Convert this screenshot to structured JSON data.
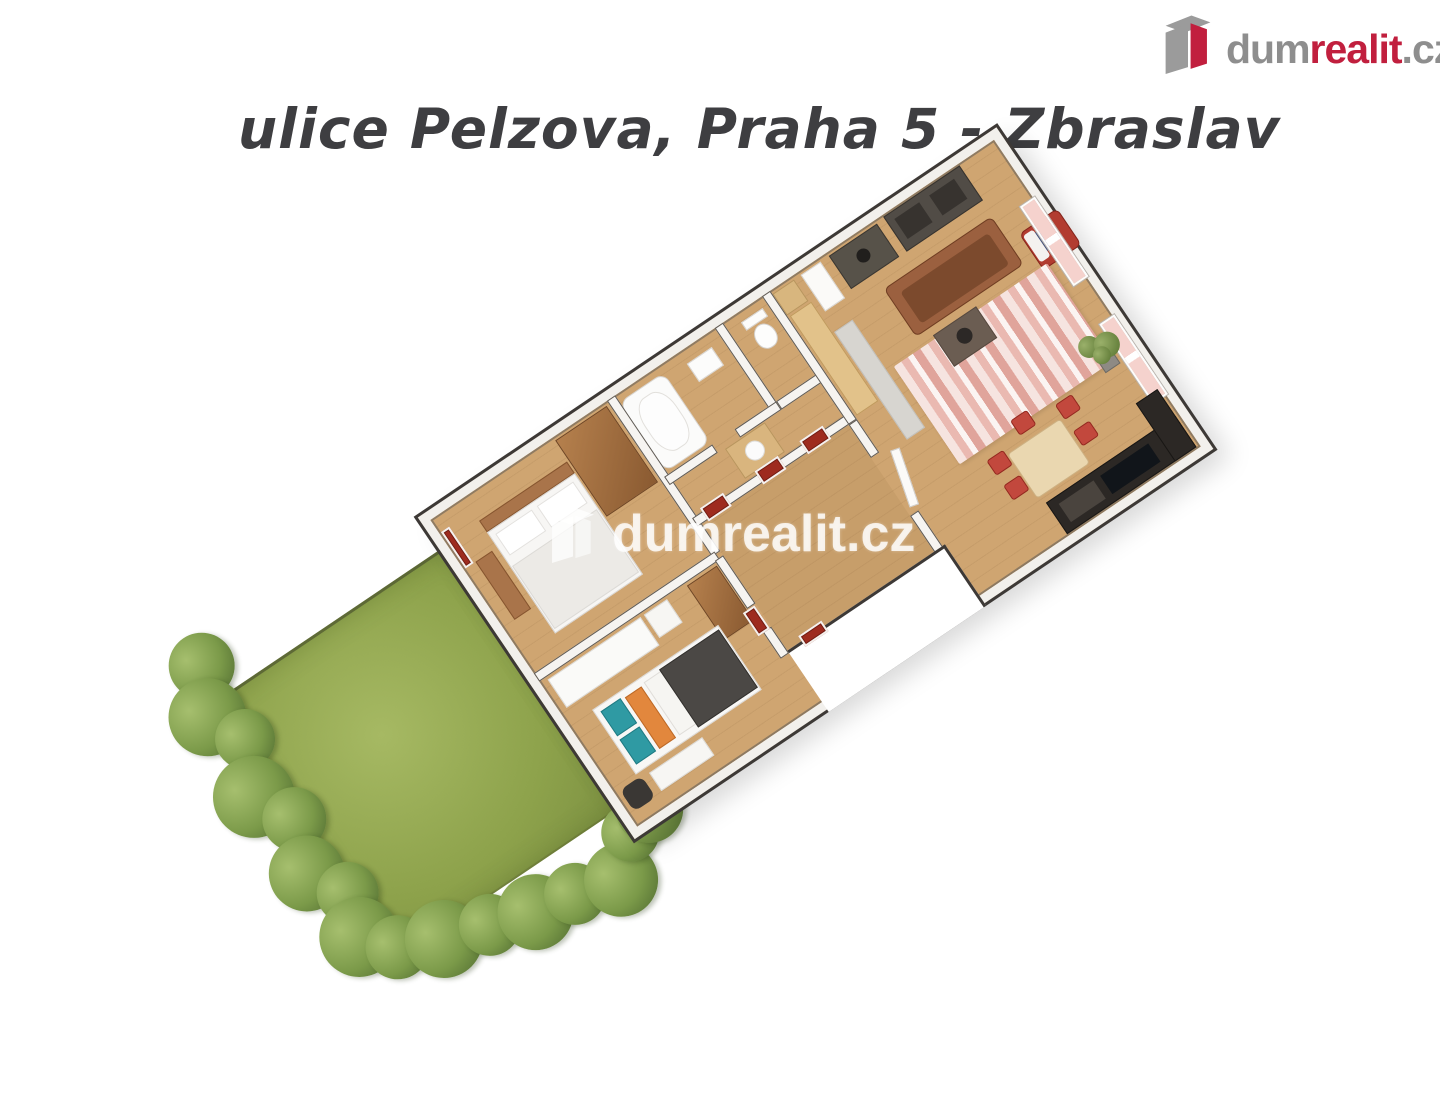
{
  "header": {
    "title": "ulice Pelzova, Praha 5 - Zbraslav"
  },
  "logo": {
    "dum": "dum",
    "realit": "realit",
    "cz": ".cz",
    "icon": "dumrealit-building-icon",
    "color_red": "#c11f3e",
    "color_gray": "#8e8e8e"
  },
  "watermark": {
    "text": "dumrealit.cz"
  },
  "floorplan": {
    "type": "3d-isometric-floor-plan",
    "rooms": [
      "living-room",
      "kitchen-corner",
      "bedroom-1",
      "bedroom-2",
      "bathroom",
      "wc",
      "hallway",
      "garden-lawn"
    ],
    "palette": {
      "floor_wood": "#cfa571",
      "wall_white": "#f6f4f1",
      "outline_dark": "#3d3936",
      "lawn_green": "#8da24b",
      "door_red": "#9e2b1f",
      "rug_pink": "#eab9b1",
      "sofa_brown": "#9b603f",
      "accent_teal": "#2f9aa3",
      "accent_orange": "#e2873d"
    }
  }
}
